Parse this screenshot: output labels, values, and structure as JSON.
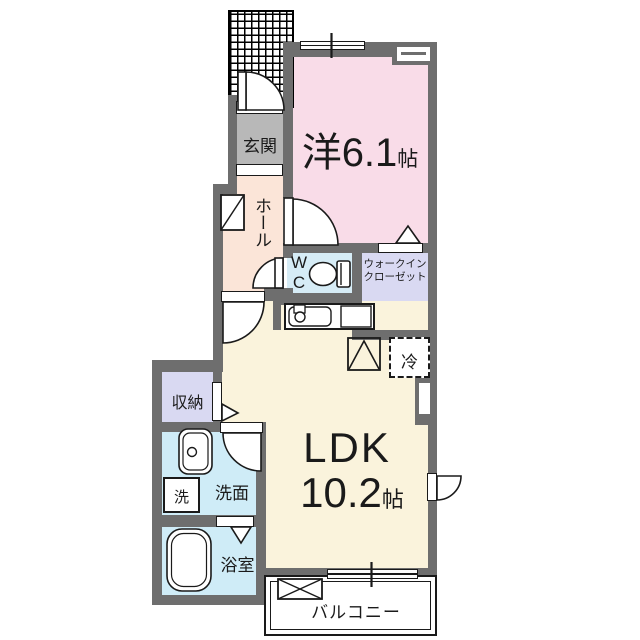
{
  "floorplan": {
    "rooms": {
      "entrance": {
        "label": "玄関"
      },
      "hall": {
        "label": "ホール"
      },
      "western_room": {
        "name": "洋",
        "size": "6.1",
        "unit": "帖"
      },
      "wc": {
        "line1": "W",
        "line2": "C"
      },
      "walk_in_closet": {
        "line1": "ウォークイン",
        "line2": "クローゼット"
      },
      "refrigerator": {
        "label": "冷"
      },
      "storage": {
        "label": "収納"
      },
      "washer": {
        "label": "洗"
      },
      "washroom": {
        "label": "洗面"
      },
      "bathroom": {
        "label": "浴室"
      },
      "ldk": {
        "name": "LDK",
        "size": "10.2",
        "unit": "帖"
      },
      "balcony": {
        "label": "バルコニー"
      }
    },
    "colors": {
      "wall": "#6e6e6e",
      "western_room": "#f9dce8",
      "hall": "#fbe5d8",
      "entrance_floor": "#b8b8b8",
      "wc": "#d6ecf6",
      "walk_in_closet": "#d9d9f2",
      "storage": "#d9d9f2",
      "washroom": "#cfecf7",
      "bathroom": "#cfecf7",
      "ldk": "#faf3dc",
      "line": "#1a1a1a"
    }
  }
}
